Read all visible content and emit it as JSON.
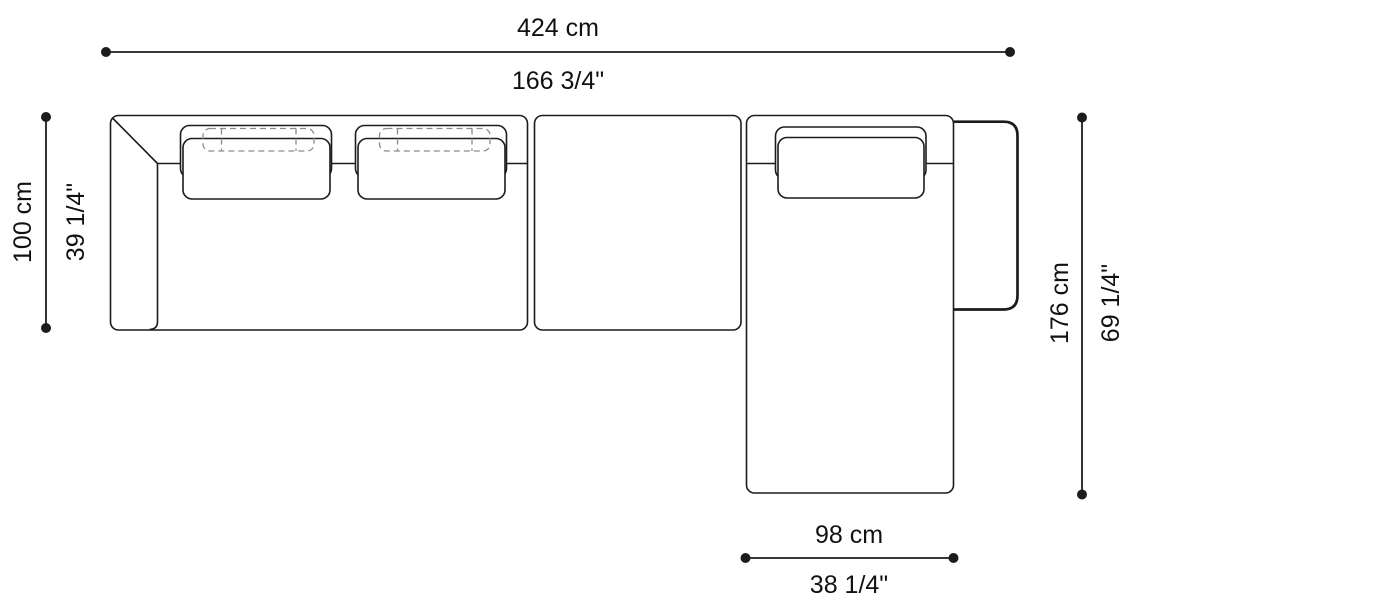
{
  "drawing": {
    "stroke_color": "#1c1c1c",
    "dashed_color": "#8c8c8c",
    "background": "#ffffff"
  },
  "dimensions": {
    "overall_width": {
      "metric": "424 cm",
      "imperial": "166 3/4\""
    },
    "depth": {
      "metric": "100 cm",
      "imperial": "39 1/4\""
    },
    "chaise_length": {
      "metric": "176 cm",
      "imperial": "69 1/4\""
    },
    "chaise_width": {
      "metric": "98 cm",
      "imperial": "38 1/4\""
    }
  }
}
